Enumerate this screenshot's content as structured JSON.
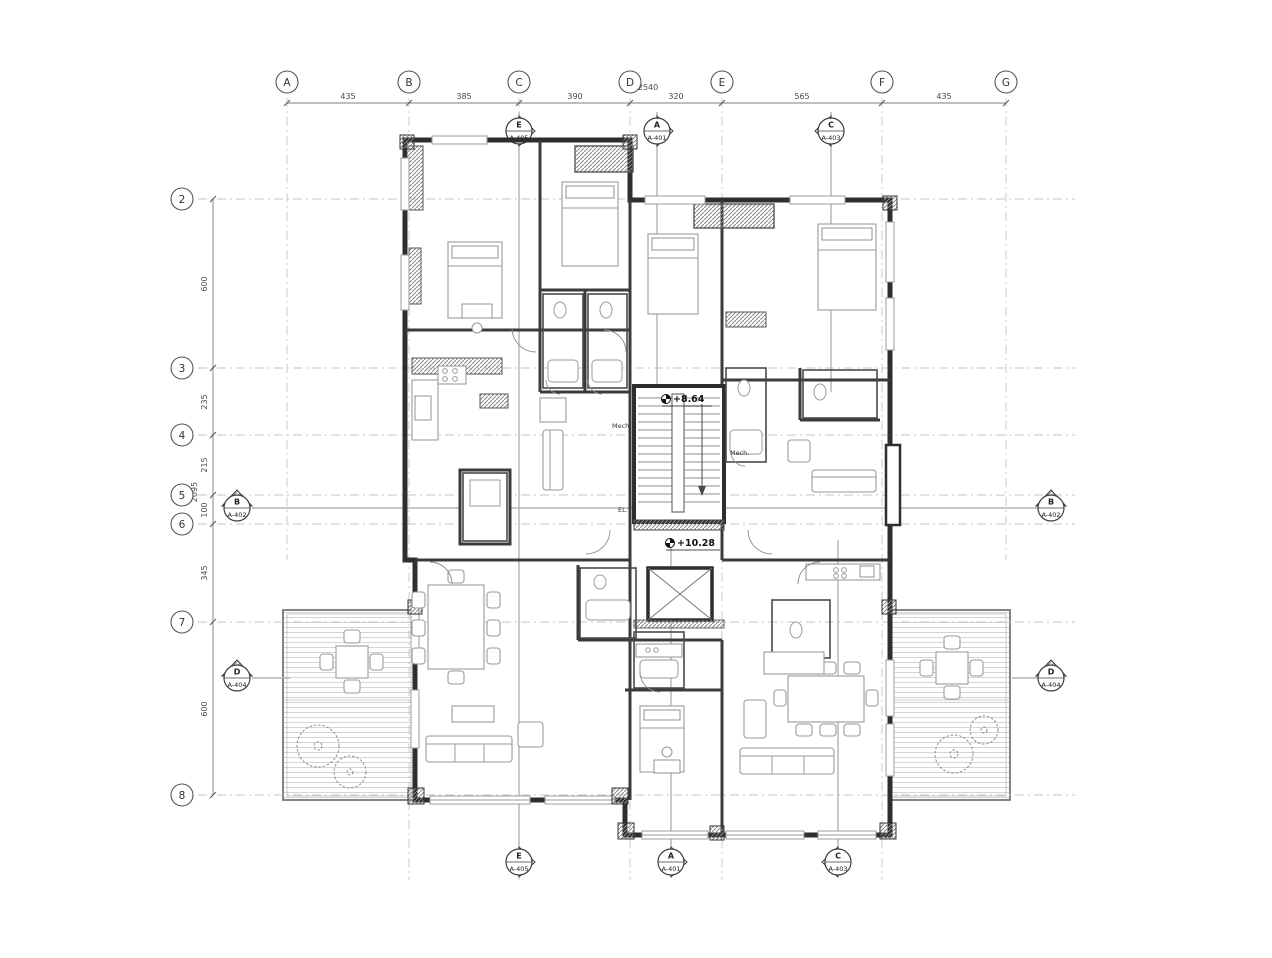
{
  "drawing": {
    "elevations": {
      "upper": "+8.64",
      "lower": "+10.28"
    },
    "labels": {
      "mech1": "Mech.",
      "mech2": "Mech.",
      "elevator": "EL."
    }
  },
  "grid": {
    "columns": [
      {
        "label": "A"
      },
      {
        "label": "B"
      },
      {
        "label": "C"
      },
      {
        "label": "D"
      },
      {
        "label": "E"
      },
      {
        "label": "F"
      },
      {
        "label": "G"
      }
    ],
    "column_dims": [
      "435",
      "385",
      "390",
      "320",
      "565",
      "435"
    ],
    "column_total": "2540",
    "rows": [
      {
        "label": "2"
      },
      {
        "label": "3"
      },
      {
        "label": "4"
      },
      {
        "label": "5"
      },
      {
        "label": "6"
      },
      {
        "label": "7"
      },
      {
        "label": "8"
      }
    ],
    "row_dims": [
      "600",
      "235",
      "215",
      "100",
      "345",
      "600"
    ],
    "row_total": "2095"
  },
  "section_markers": {
    "top": [
      {
        "letter": "E",
        "sheet": "A-405"
      },
      {
        "letter": "A",
        "sheet": "A-401"
      },
      {
        "letter": "C",
        "sheet": "A-403"
      }
    ],
    "bottom": [
      {
        "letter": "E",
        "sheet": "A-405"
      },
      {
        "letter": "A",
        "sheet": "A-401"
      },
      {
        "letter": "C",
        "sheet": "A-403"
      }
    ],
    "left": [
      {
        "letter": "B",
        "sheet": "A-402"
      },
      {
        "letter": "D",
        "sheet": "A-404"
      }
    ],
    "right": [
      {
        "letter": "B",
        "sheet": "A-402"
      },
      {
        "letter": "D",
        "sheet": "A-404"
      }
    ]
  },
  "colors": {
    "wall": "#2e2e2e",
    "line": "#555555",
    "grid": "#c6c6c6"
  }
}
